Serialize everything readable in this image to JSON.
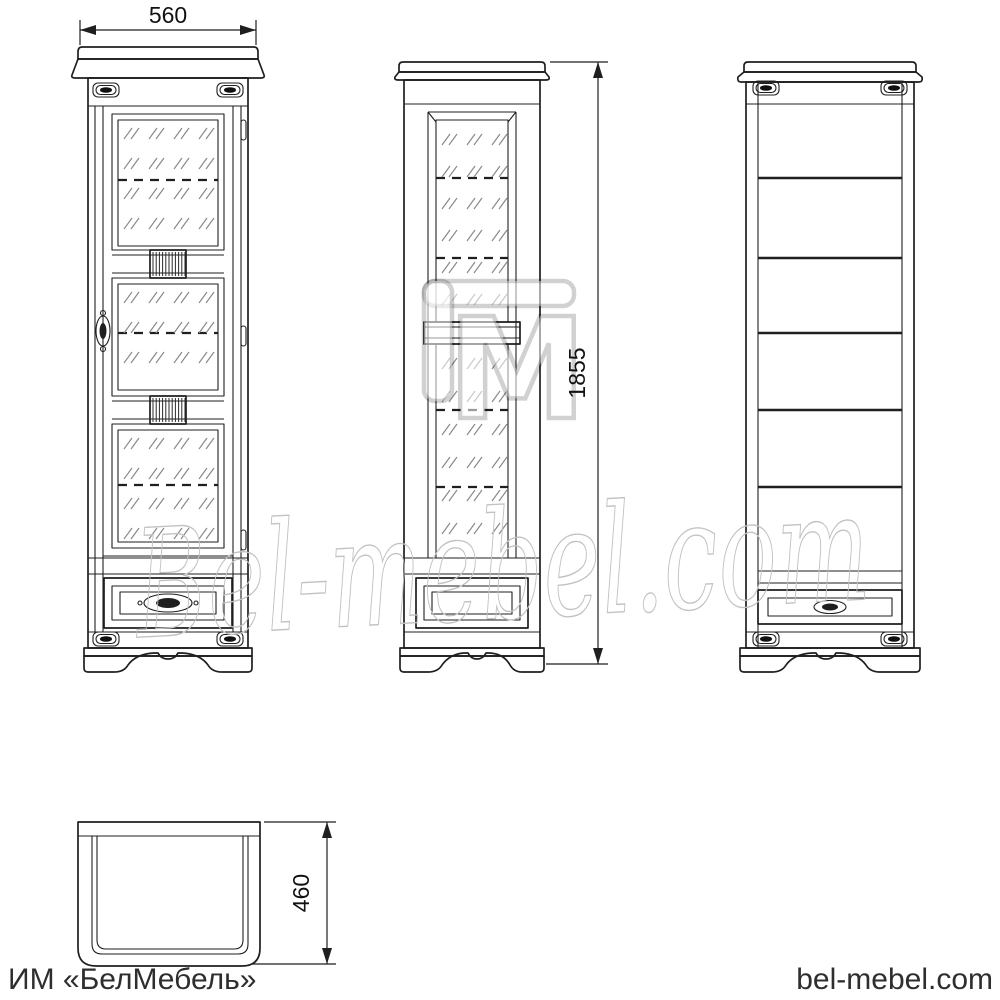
{
  "drawing": {
    "background": "#ffffff",
    "line_color": "#1f1f1f",
    "hatch_color": "#8a8a8a",
    "watermark_color": "#c2c2c2",
    "footer_text_color": "#2e2e2e"
  },
  "dimensions": {
    "width": {
      "label": "560"
    },
    "height": {
      "label": "1855"
    },
    "depth": {
      "label": "460"
    }
  },
  "watermark": {
    "script": "Bel-mebel.com",
    "logo": "M"
  },
  "footer": {
    "left": "ИМ «БелМебель»",
    "right": "bel-mebel.com"
  }
}
